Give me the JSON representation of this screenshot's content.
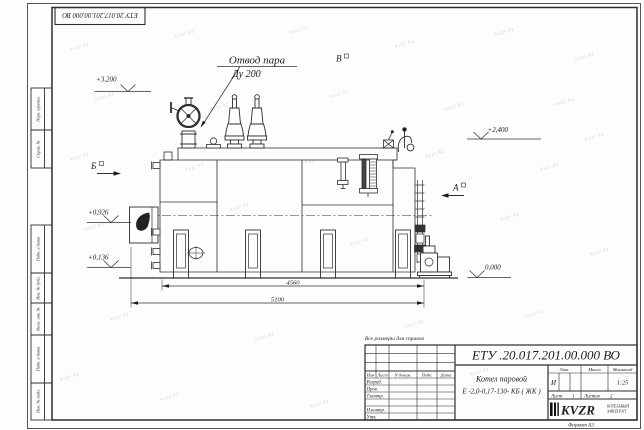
{
  "sheet": {
    "doc_number_top": "ЕТУ 20.017.201.00.000  ВО",
    "format_label": "Формат А3"
  },
  "watermark": {
    "text": "kvzr.kz",
    "positions": [
      [
        70,
        45
      ],
      [
        175,
        32
      ],
      [
        290,
        28
      ],
      [
        395,
        42
      ],
      [
        495,
        30
      ],
      [
        575,
        55
      ],
      [
        95,
        95
      ],
      [
        210,
        105
      ],
      [
        330,
        92
      ],
      [
        445,
        105
      ],
      [
        555,
        100
      ],
      [
        70,
        155
      ],
      [
        185,
        165
      ],
      [
        305,
        158
      ],
      [
        425,
        152
      ],
      [
        540,
        165
      ],
      [
        85,
        225
      ],
      [
        350,
        240
      ],
      [
        500,
        215
      ],
      [
        585,
        135
      ],
      [
        110,
        315
      ],
      [
        255,
        335
      ],
      [
        405,
        322
      ],
      [
        525,
        312
      ],
      [
        160,
        395
      ],
      [
        310,
        402
      ],
      [
        60,
        375
      ],
      [
        590,
        250
      ],
      [
        470,
        370
      ],
      [
        230,
        205
      ]
    ]
  },
  "margin_columns": {
    "perv_primen": "Перв. примен.",
    "sprav_no": "Справ. №",
    "podp_data_1": "Подп. и дата",
    "inv_dubl": "Инв. № дубл.",
    "vzam_inv": "Взам. инв. №",
    "podp_data_2": "Подп. и дата",
    "inv_podl": "Инв. № подл."
  },
  "drawing": {
    "labels": {
      "steam_outlet_line1": "Отвод пара",
      "steam_outlet_line2": "Ду 200",
      "view_b_top": "В",
      "section_b": "Б",
      "section_a": "А"
    },
    "elevations": {
      "e3200": "+3,200",
      "e2400": "+2,400",
      "e0926": "+0,926",
      "e0136": "+0,136",
      "e0000": "0,000"
    },
    "dimensions": {
      "d4560": "4560",
      "d5100": "5100"
    },
    "note": "Все размеры для справок"
  },
  "title_block": {
    "doc_number": "ЕТУ .20.017.201.00.000  ВО",
    "product_name_line1": "Котел паровой",
    "product_name_line2": "Е -2,0-0,17-130- КБ ( ЖК )",
    "header_izm": "Изм",
    "header_list": "Лист",
    "header_ndokum": "N докум.",
    "header_podp": "Подп.",
    "header_data": "Дата",
    "row_razrab": "Разраб.",
    "row_prov": "Пров.",
    "row_tkontr": "Т.контр.",
    "row_nkontr": "Н.контр.",
    "row_utv": "Утв.",
    "lit_header": "Лит.",
    "massa_header": "Масса",
    "masshtab_header": "Масштаб",
    "lit_value": "И",
    "scale_value": "1:25",
    "sheet_label": "Лист",
    "sheet_value": "1",
    "sheets_label": "Листов",
    "sheets_value": "2",
    "logo_text": "KVZR",
    "logo_sub1": "КОТЕЛЬНЫЙ",
    "logo_sub2": "ЗАВОД РЭП"
  }
}
